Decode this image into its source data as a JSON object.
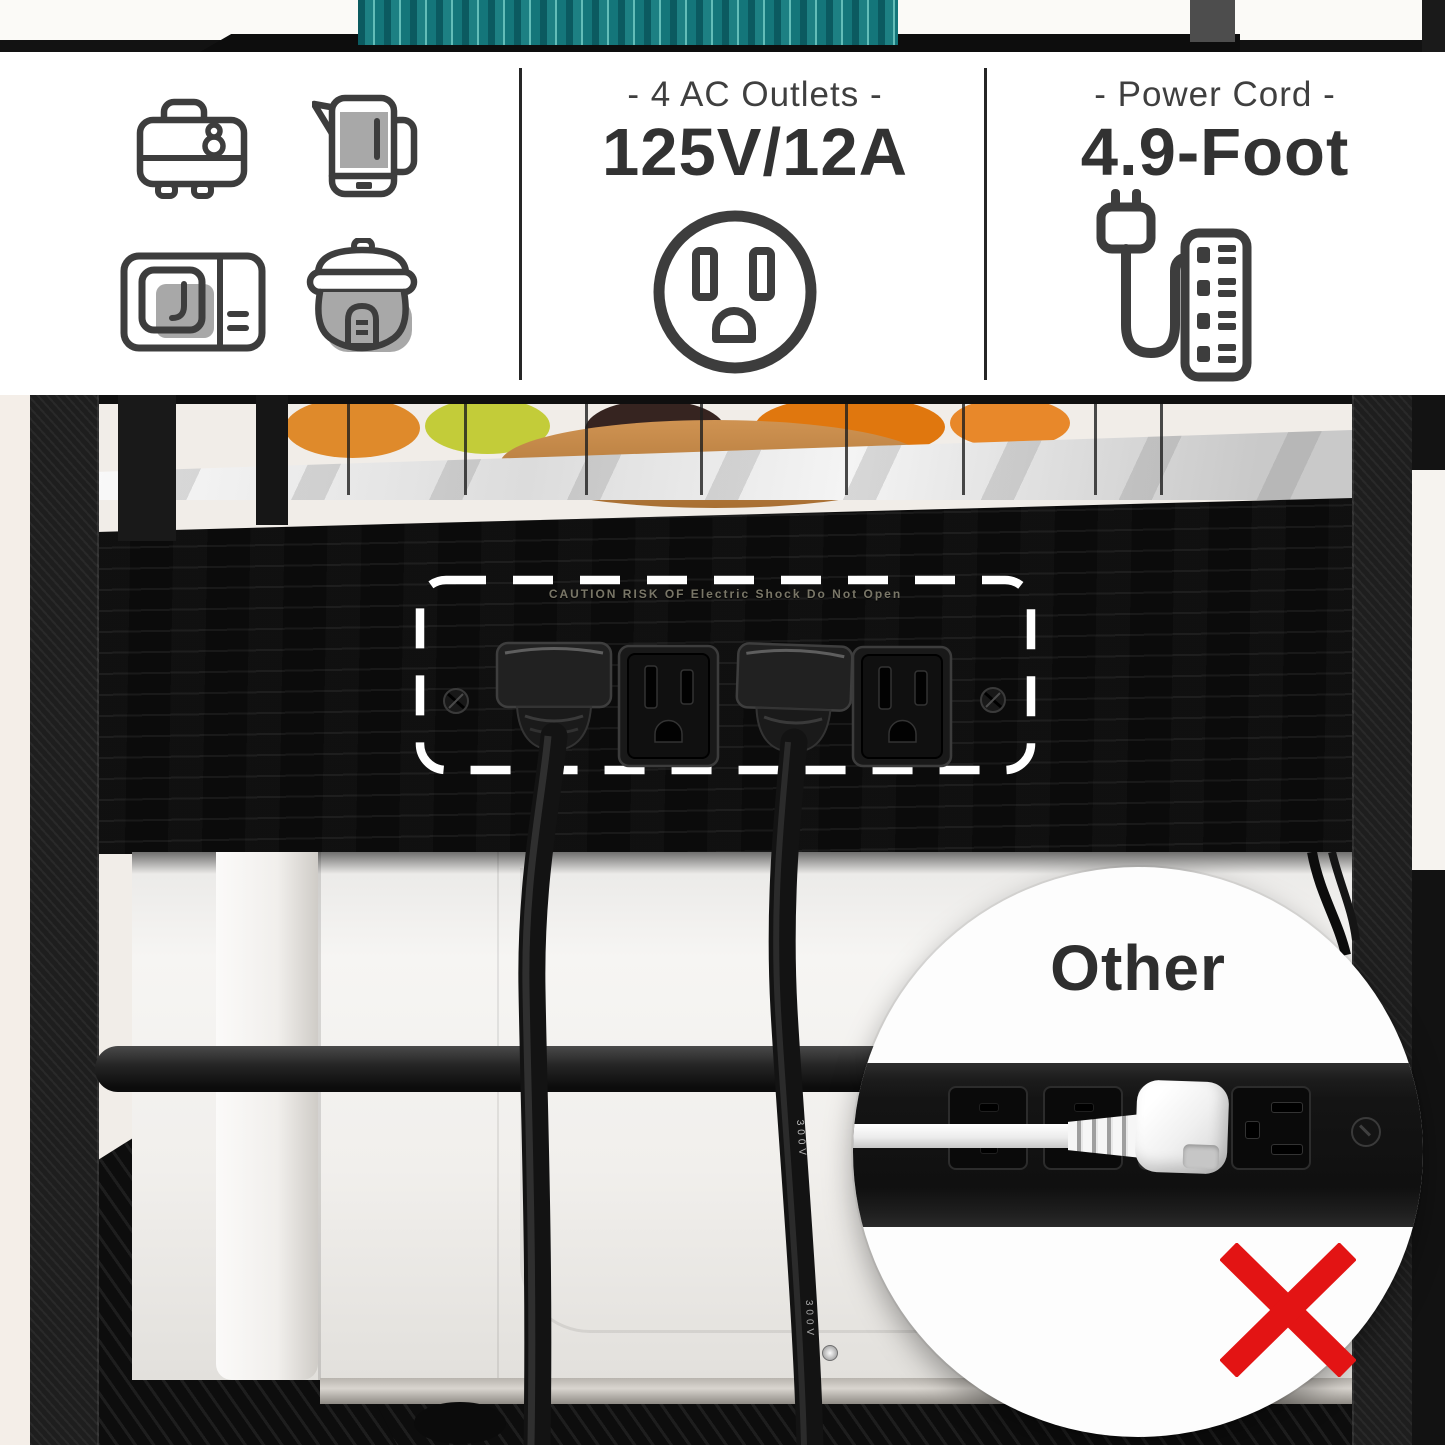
{
  "header": {
    "appliance_icons": [
      "toaster-icon",
      "kettle-icon",
      "microwave-icon",
      "rice-cooker-icon"
    ],
    "outlets_panel": {
      "label": "- 4 AC Outlets -",
      "value": "125V/12A",
      "icon": "ac-outlet-icon"
    },
    "cord_panel": {
      "label": "- Power Cord -",
      "value": "4.9-Foot",
      "icon": "plug-power-strip-icon"
    }
  },
  "photo": {
    "outlet_caution_text": "CAUTION RISK OF Electric Shock Do Not Open",
    "cable_print": "300V",
    "inset": {
      "title": "Other",
      "icon": "red-x-icon"
    }
  },
  "colors": {
    "teal_vase": "#1d8083",
    "red_x": "#e31414",
    "icon_stroke": "#3d3d3d",
    "icon_accent": "#a8a8a8",
    "panel_wood": "#0b0b0b"
  }
}
